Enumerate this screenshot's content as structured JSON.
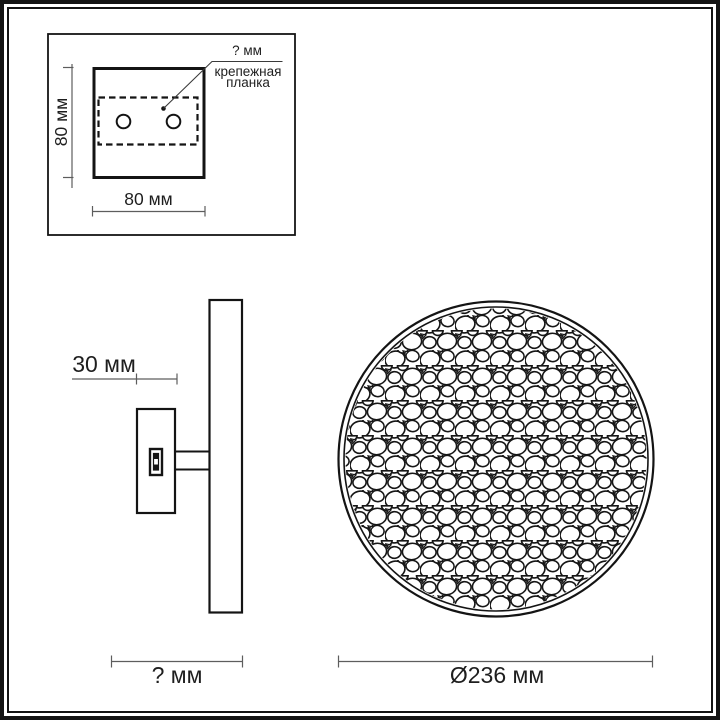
{
  "colors": {
    "ink": "#141414",
    "dim_line": "#5d5d5d",
    "text": "#1e1e1e",
    "background": "#ffffff"
  },
  "detail_inset": {
    "bracket_width_label": "? мм",
    "bracket_caption_line1": "крепежная",
    "bracket_caption_line2": "планка",
    "plate_height_label": "80 мм",
    "plate_width_label": "80 мм"
  },
  "side_view": {
    "plate_depth_label": "30 мм",
    "overall_depth_label": "? мм"
  },
  "front_view": {
    "diameter_label": "Ø236 мм"
  }
}
